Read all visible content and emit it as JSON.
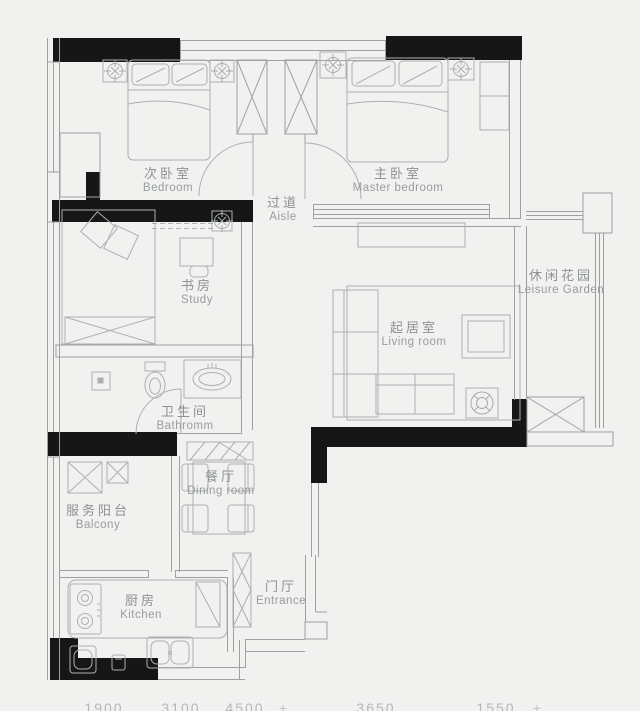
{
  "page": {
    "background": "#f1f1ef"
  },
  "colors": {
    "wall_fill": "#161616",
    "wall_line": "#9ba1a6",
    "furniture_line": "#abb0b4",
    "label_text": "#8d9296",
    "dimension_text": "#b4b8ba"
  },
  "rooms": [
    {
      "id": "bedroom",
      "zh": "次卧室",
      "en": "Bedroom"
    },
    {
      "id": "master-bedroom",
      "zh": "主卧室",
      "en": "Master bedroom"
    },
    {
      "id": "aisle",
      "zh": "过道",
      "en": "Aisle"
    },
    {
      "id": "study",
      "zh": "书房",
      "en": "Study"
    },
    {
      "id": "leisure-garden",
      "zh": "休闲花园",
      "en": "Leisure Garden"
    },
    {
      "id": "living-room",
      "zh": "起居室",
      "en": "Living room"
    },
    {
      "id": "bathroom",
      "zh": "卫生间",
      "en": "Bathromm"
    },
    {
      "id": "dining-room",
      "zh": "餐厅",
      "en": "Dining room"
    },
    {
      "id": "balcony",
      "zh": "服务阳台",
      "en": "Balcony"
    },
    {
      "id": "kitchen",
      "zh": "厨房",
      "en": "Kitchen"
    },
    {
      "id": "entrance",
      "zh": "门厅",
      "en": "Entrance"
    }
  ],
  "dimensions": {
    "values": [
      "1900",
      "3100",
      "4500",
      "3650",
      "1550"
    ],
    "tick": "+"
  }
}
